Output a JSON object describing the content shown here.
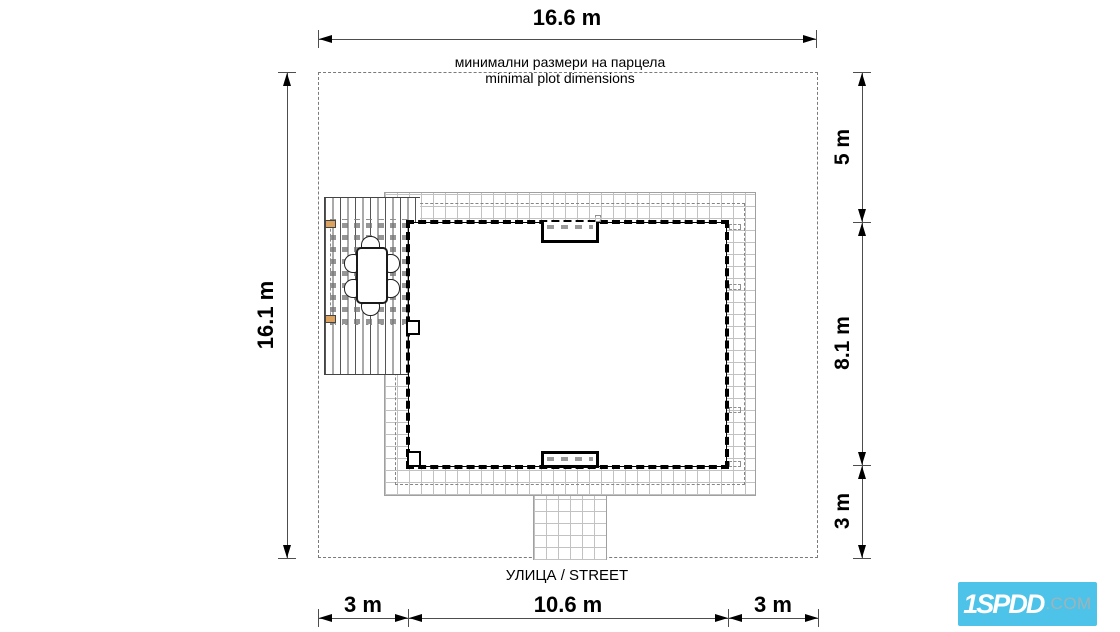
{
  "plan_title": {
    "bg": "минимални размери на парцела",
    "en": "minimal plot dimensions"
  },
  "street_label": "УЛИЦА / STREET",
  "dimensions": {
    "top_width": "16.6 m",
    "left_height": "16.1 m",
    "right_top": "5 m",
    "right_middle": "8.1 m",
    "right_bottom": "3 m",
    "bottom_left": "3 m",
    "bottom_middle": "10.6 m",
    "bottom_right": "3 m"
  },
  "logo": {
    "main": "1SPDD",
    "suffix": ".COM",
    "background": "#4ec3e9",
    "suffix_color": "#9fb3b8"
  },
  "colors": {
    "post_orange": "#dba35f",
    "wall_black": "#000000",
    "grid_gray": "#c2c2c2",
    "boundary_gray": "#7a7a7a",
    "dimension_line": "#4d4d4d"
  }
}
